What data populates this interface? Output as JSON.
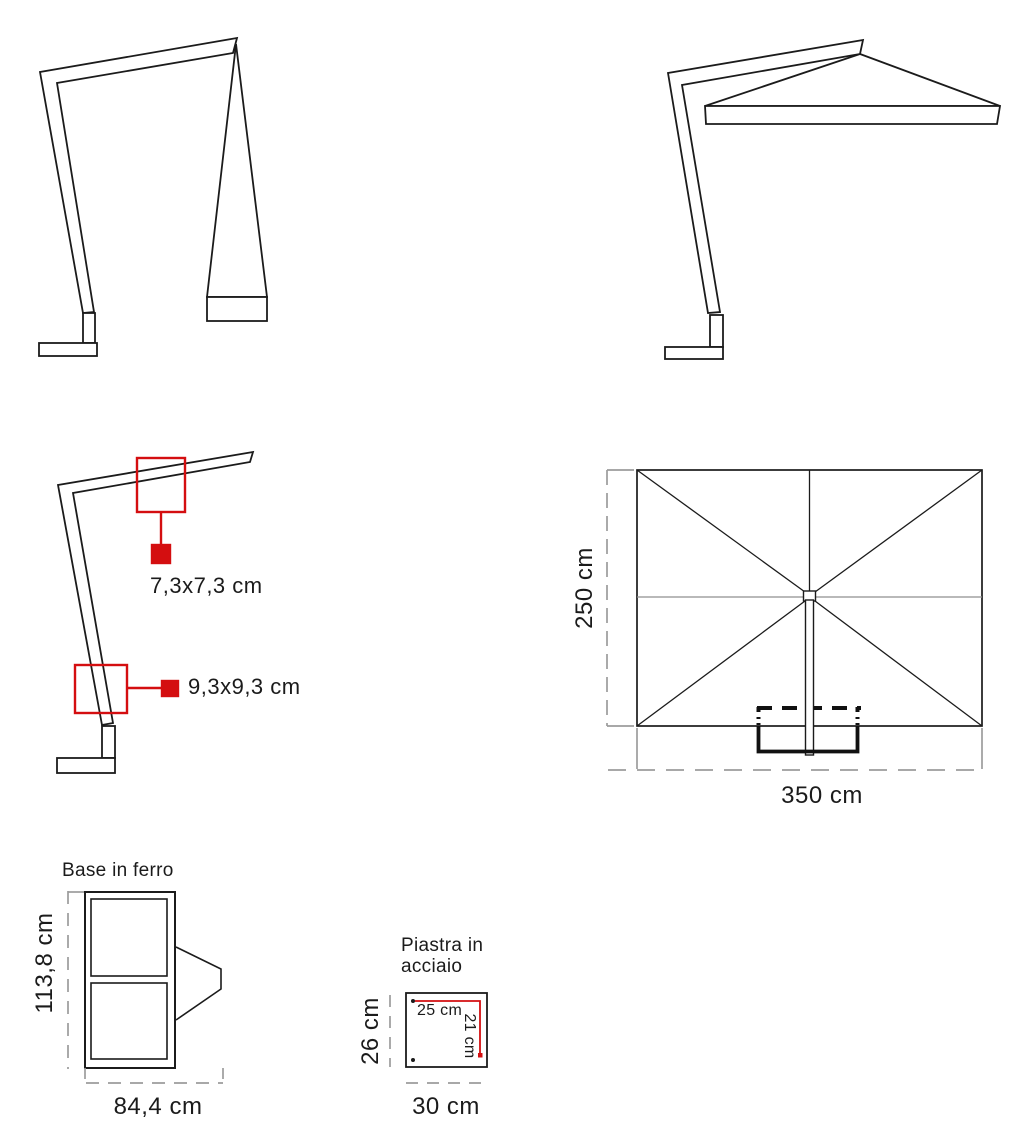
{
  "colors": {
    "line": "#1b1b1b",
    "thick": "#111111",
    "red": "#d40e10",
    "gray_dash": "#9c9c9c",
    "background": "#ffffff"
  },
  "frame_detail": {
    "upper_callout": "7,3x7,3 cm",
    "lower_callout": "9,3x9,3 cm"
  },
  "top_view": {
    "depth": "250 cm",
    "width": "350 cm"
  },
  "base": {
    "title": "Base in ferro",
    "height": "113,8 cm",
    "width": "84,4 cm"
  },
  "plate": {
    "title_line1": "Piastra in",
    "title_line2": "acciaio",
    "height": "26 cm",
    "width": "30 cm",
    "hole_spacing_width": "25 cm",
    "hole_spacing_height": "21 cm"
  }
}
